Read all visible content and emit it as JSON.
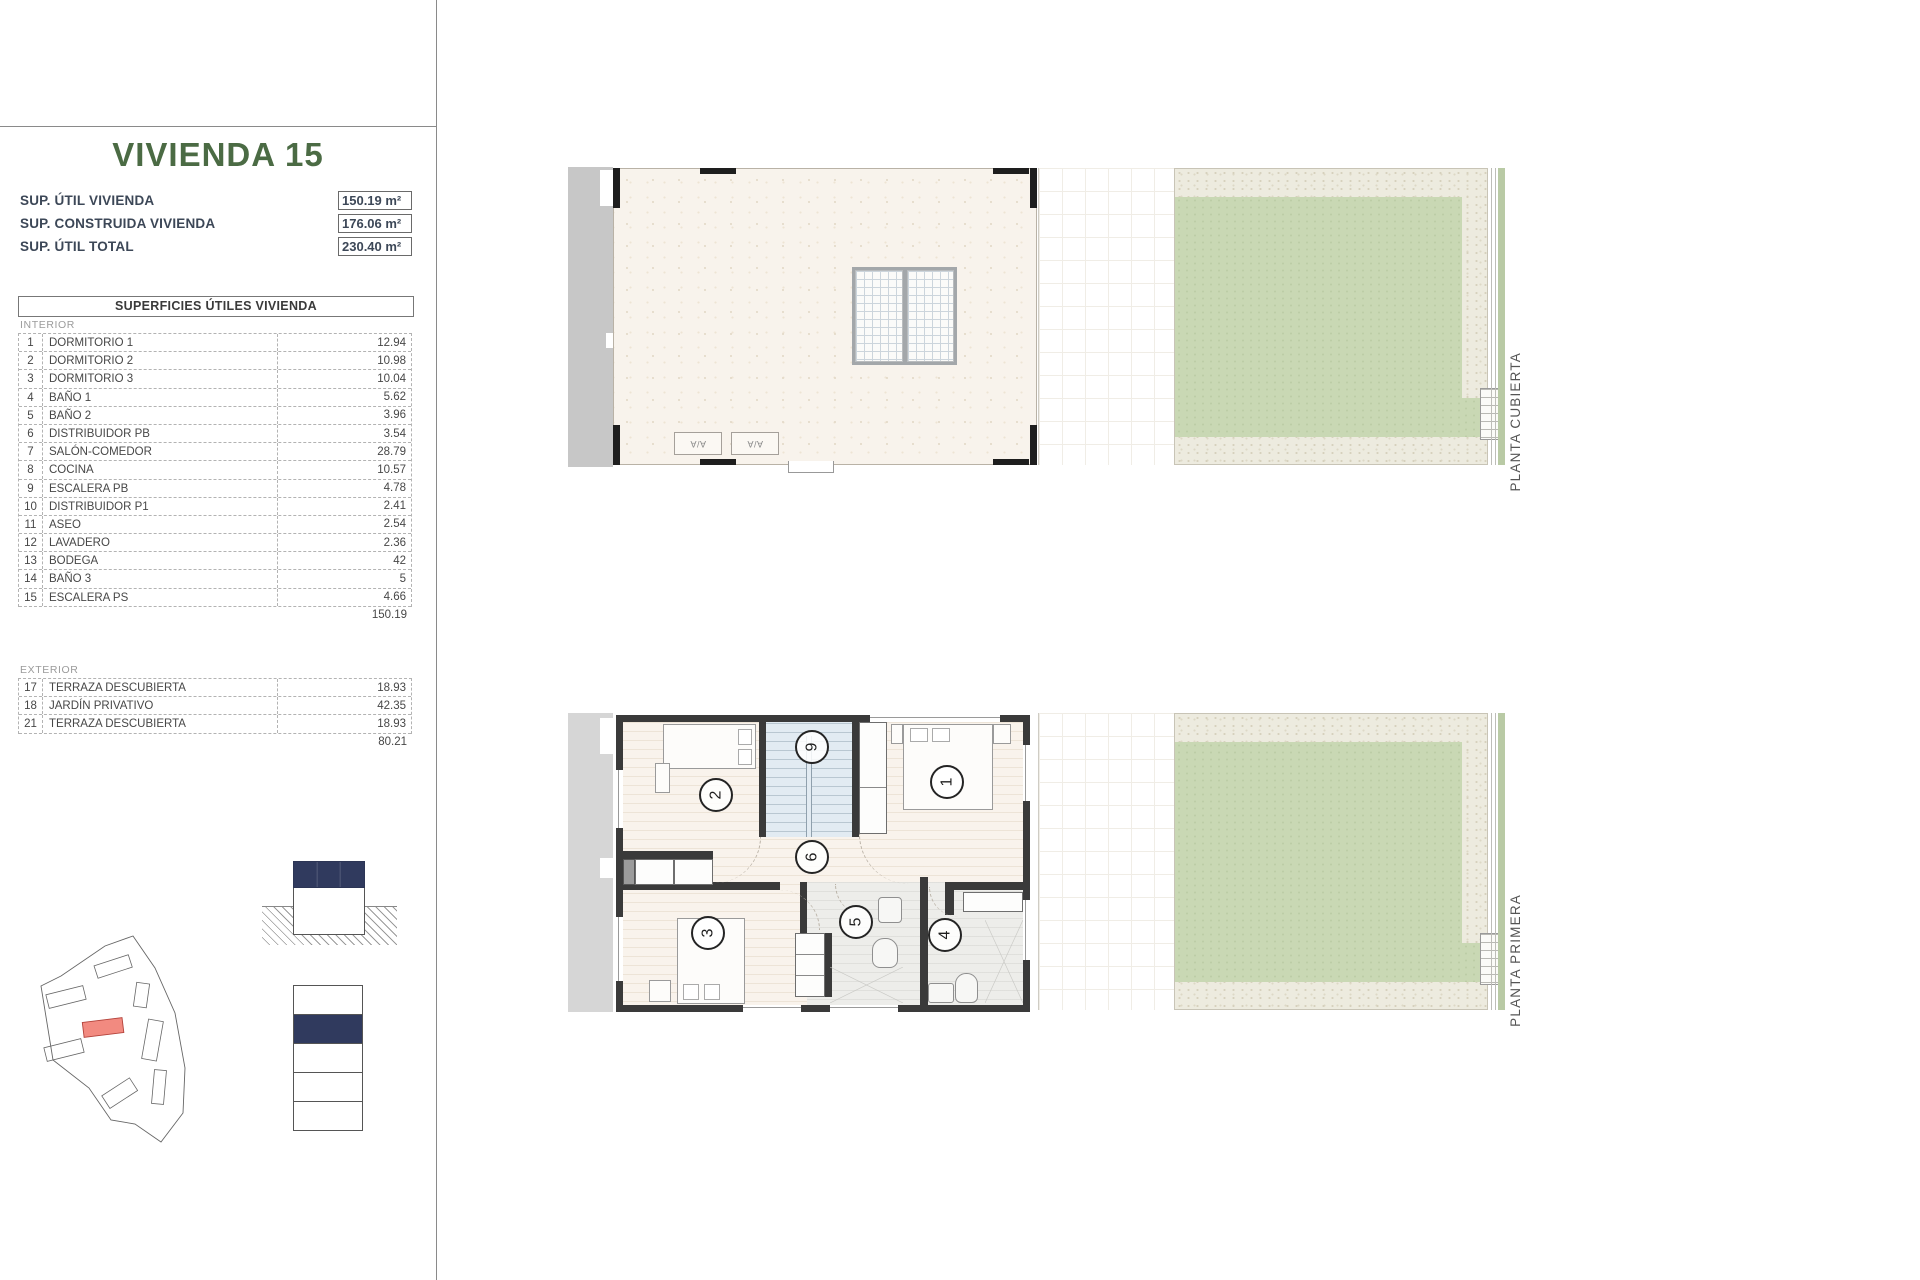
{
  "sidebar": {
    "title": "VIVIENDA 15",
    "summary": [
      {
        "label": "SUP. ÚTIL VIVIENDA",
        "value": "150.19 m²"
      },
      {
        "label": "SUP. CONSTRUIDA VIVIENDA",
        "value": "176.06 m²"
      },
      {
        "label": "SUP. ÚTIL TOTAL",
        "value": "230.40 m²"
      }
    ],
    "table": {
      "header": "SUPERFICIES ÚTILES VIVIENDA",
      "interior_label": "INTERIOR",
      "interior_rows": [
        {
          "num": "1",
          "name": "DORMITORIO 1",
          "value": "12.94"
        },
        {
          "num": "2",
          "name": "DORMITORIO 2",
          "value": "10.98"
        },
        {
          "num": "3",
          "name": "DORMITORIO 3",
          "value": "10.04"
        },
        {
          "num": "4",
          "name": "BAÑO 1",
          "value": "5.62"
        },
        {
          "num": "5",
          "name": "BAÑO 2",
          "value": "3.96"
        },
        {
          "num": "6",
          "name": "DISTRIBUIDOR PB",
          "value": "3.54"
        },
        {
          "num": "7",
          "name": "SALÓN-COMEDOR",
          "value": "28.79"
        },
        {
          "num": "8",
          "name": "COCINA",
          "value": "10.57"
        },
        {
          "num": "9",
          "name": "ESCALERA PB",
          "value": "4.78"
        },
        {
          "num": "10",
          "name": "DISTRIBUIDOR P1",
          "value": "2.41"
        },
        {
          "num": "11",
          "name": "ASEO",
          "value": "2.54"
        },
        {
          "num": "12",
          "name": "LAVADERO",
          "value": "2.36"
        },
        {
          "num": "13",
          "name": "BODEGA",
          "value": "42"
        },
        {
          "num": "14",
          "name": "BAÑO 3",
          "value": "5"
        },
        {
          "num": "15",
          "name": "ESCALERA PS",
          "value": "4.66"
        }
      ],
      "interior_total": "150.19",
      "exterior_label": "EXTERIOR",
      "exterior_rows": [
        {
          "num": "17",
          "name": "TERRAZA DESCUBIERTA",
          "value": "18.93"
        },
        {
          "num": "18",
          "name": "JARDÍN PRIVATIVO",
          "value": "42.35"
        },
        {
          "num": "21",
          "name": "TERRAZA DESCUBIERTA",
          "value": "18.93"
        }
      ],
      "exterior_total": "80.21"
    }
  },
  "plans": {
    "top": {
      "label": "PLANTA CUBIERTA",
      "ac_label": "A/A"
    },
    "bottom": {
      "label": "PLANTA PRIMERA",
      "room_numbers": {
        "r1": "1",
        "r2": "2",
        "r3": "3",
        "r4": "4",
        "r5": "5",
        "r6": "6",
        "r9": "9"
      }
    }
  },
  "colors": {
    "accent_green": "#4b6b44",
    "navy": "#303a5e",
    "highlight_red": "#f28a80",
    "garden_green": "#c9d8b4",
    "wall_dark": "#3a3a3a"
  }
}
